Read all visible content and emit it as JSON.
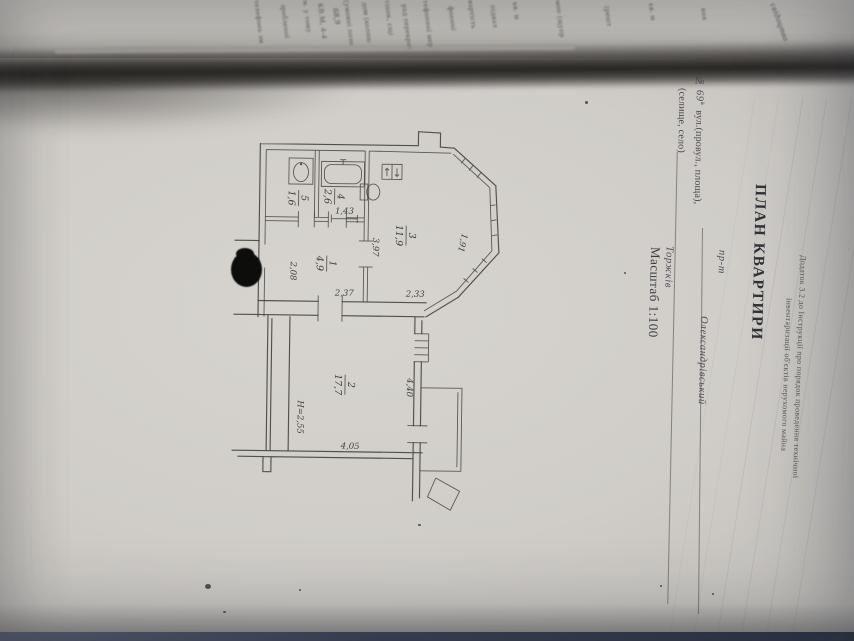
{
  "page": {
    "appendix_note": {
      "line1": "Додаток 3.2 до Інструкції про порядок проведення технічної",
      "line2": "інвентаризації об'єктів нерухомого майна"
    },
    "title": "ПЛАН КВАРТИРИ",
    "address": {
      "number_label": "№",
      "house_no": "69",
      "house_no_suffix": "а",
      "line1_label": "вул.(провул., площа),",
      "street_prefix_handwritten": "пр-т",
      "street_name_handwritten": "Олександрівський",
      "line2_label": "(селище, село)",
      "settlement_handwritten": "Торжків"
    },
    "scale_label": "Масштаб 1:100"
  },
  "plan": {
    "rooms": [
      {
        "number": "5",
        "area": "1,6"
      },
      {
        "number": "4",
        "area": "2,6"
      },
      {
        "number": "3",
        "area": "11,9"
      },
      {
        "number": "1",
        "area": "4,9"
      },
      {
        "number": "2",
        "area": "17,7"
      }
    ],
    "dims": [
      "1,43",
      "3,97",
      "2,08",
      "2,37",
      "2,33",
      "1,91",
      "4,40",
      "Н=2,55",
      "4,05"
    ]
  },
  "facing": {
    "fragments": [
      "телефонь зм",
      "зробленої",
      "м. у тому",
      "КВ.М, 4-4",
      "68,9",
      "(умовні позн",
      "дом (колиш",
      "тінок, сщі",
      "рад перекрит",
      "тефонної мер",
      "фонної",
      "вартість",
      "підвал",
      "кв. м",
      "мон (щупр",
      "(решт",
      "кв. м",
      "вня",
      "свідоцтво"
    ]
  },
  "colors": {
    "paper": "#d0cdc8",
    "ink": "#46443f",
    "fold_shadow": "#262421",
    "table_edge": "#3c4358"
  }
}
